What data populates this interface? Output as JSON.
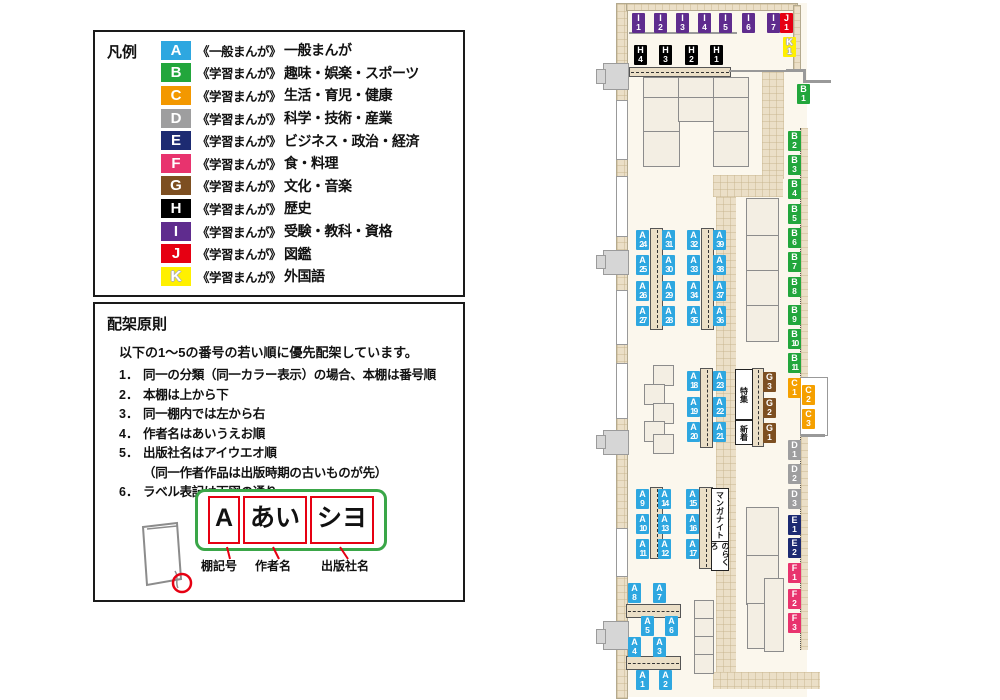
{
  "legend": {
    "title": "凡例",
    "items": [
      {
        "letter": "A",
        "color": "#2EA7E0",
        "series": "《一般まんが》",
        "category": "一般まんが"
      },
      {
        "letter": "B",
        "color": "#22A63C",
        "series": "《学習まんが》",
        "category": "趣味・娯楽・スポーツ"
      },
      {
        "letter": "C",
        "color": "#F39800",
        "series": "《学習まんが》",
        "category": "生活・育児・健康"
      },
      {
        "letter": "D",
        "color": "#9E9E9F",
        "series": "《学習まんが》",
        "category": "科学・技術・産業"
      },
      {
        "letter": "E",
        "color": "#1D2B72",
        "series": "《学習まんが》",
        "category": "ビジネス・政治・経済"
      },
      {
        "letter": "F",
        "color": "#E8336E",
        "series": "《学習まんが》",
        "category": "食・料理"
      },
      {
        "letter": "G",
        "color": "#7D4F21",
        "series": "《学習まんが》",
        "category": "文化・音楽"
      },
      {
        "letter": "H",
        "color": "#000000",
        "series": "《学習まんが》",
        "category": "歴史"
      },
      {
        "letter": "I",
        "color": "#5F2C8E",
        "series": "《学習まんが》",
        "category": "受験・教科・資格"
      },
      {
        "letter": "J",
        "color": "#E60012",
        "series": "《学習まんが》",
        "category": "図鑑"
      },
      {
        "letter": "K",
        "color": "#FFF000",
        "series": "《学習まんが》",
        "category": "外国語"
      }
    ]
  },
  "rules": {
    "title": "配架原則",
    "intro": "以下の1～5の番号の若い順に優先配架しています。",
    "items": [
      {
        "num": "1．",
        "text": "同一の分類（同一カラー表示）の場合、本棚は番号順"
      },
      {
        "num": "2．",
        "text": "本棚は上から下"
      },
      {
        "num": "3．",
        "text": "同一棚内では左から右"
      },
      {
        "num": "4．",
        "text": "作者名はあいうえお順"
      },
      {
        "num": "5．",
        "text": "出版社名はアイウエオ順"
      },
      {
        "num": "",
        "text": "（同一作者作品は出版時期の古いものが先）"
      },
      {
        "num": "6．",
        "text": "ラベル表記は下図の通り"
      }
    ],
    "label_diagram": {
      "cells": [
        "A",
        "あい",
        "シヨ"
      ],
      "captions": [
        "棚記号",
        "作者名",
        "出版社名"
      ]
    }
  },
  "map": {
    "colors": {
      "A": "#2EA7E0",
      "B": "#22A63C",
      "C": "#F5A000",
      "D": "#9E9E9F",
      "E": "#1D2B72",
      "F": "#E8336E",
      "G": "#7D4F21",
      "H": "#000000",
      "I": "#5F2C8E",
      "J": "#E60012",
      "K": "#FFF000"
    },
    "labels": [
      {
        "id": "A1",
        "x": 636,
        "y": 670
      },
      {
        "id": "A2",
        "x": 659,
        "y": 670
      },
      {
        "id": "A3",
        "x": 653,
        "y": 637
      },
      {
        "id": "A4",
        "x": 628,
        "y": 637
      },
      {
        "id": "A5",
        "x": 641,
        "y": 616
      },
      {
        "id": "A6",
        "x": 665,
        "y": 616
      },
      {
        "id": "A7",
        "x": 653,
        "y": 583
      },
      {
        "id": "A8",
        "x": 628,
        "y": 583
      },
      {
        "id": "A9",
        "x": 636,
        "y": 489
      },
      {
        "id": "A10",
        "x": 636,
        "y": 514
      },
      {
        "id": "A11",
        "x": 636,
        "y": 539
      },
      {
        "id": "A12",
        "x": 658,
        "y": 539
      },
      {
        "id": "A13",
        "x": 658,
        "y": 514
      },
      {
        "id": "A14",
        "x": 658,
        "y": 489
      },
      {
        "id": "A15",
        "x": 686,
        "y": 489
      },
      {
        "id": "A16",
        "x": 686,
        "y": 514
      },
      {
        "id": "A17",
        "x": 686,
        "y": 539
      },
      {
        "id": "A18",
        "x": 687,
        "y": 371
      },
      {
        "id": "A19",
        "x": 687,
        "y": 397
      },
      {
        "id": "A20",
        "x": 687,
        "y": 422
      },
      {
        "id": "A21",
        "x": 713,
        "y": 422
      },
      {
        "id": "A22",
        "x": 713,
        "y": 397
      },
      {
        "id": "A23",
        "x": 713,
        "y": 371
      },
      {
        "id": "A24",
        "x": 636,
        "y": 230
      },
      {
        "id": "A25",
        "x": 636,
        "y": 255
      },
      {
        "id": "A26",
        "x": 636,
        "y": 281
      },
      {
        "id": "A27",
        "x": 636,
        "y": 306
      },
      {
        "id": "A28",
        "x": 662,
        "y": 306
      },
      {
        "id": "A29",
        "x": 662,
        "y": 281
      },
      {
        "id": "A30",
        "x": 662,
        "y": 255
      },
      {
        "id": "A31",
        "x": 662,
        "y": 230
      },
      {
        "id": "A32",
        "x": 687,
        "y": 230
      },
      {
        "id": "A33",
        "x": 687,
        "y": 255
      },
      {
        "id": "A34",
        "x": 687,
        "y": 281
      },
      {
        "id": "A35",
        "x": 687,
        "y": 306
      },
      {
        "id": "A36",
        "x": 713,
        "y": 306
      },
      {
        "id": "A37",
        "x": 713,
        "y": 281
      },
      {
        "id": "A38",
        "x": 713,
        "y": 255
      },
      {
        "id": "A39",
        "x": 713,
        "y": 230
      },
      {
        "id": "B1",
        "x": 797,
        "y": 84
      },
      {
        "id": "B2",
        "x": 788,
        "y": 131
      },
      {
        "id": "B3",
        "x": 788,
        "y": 155
      },
      {
        "id": "B4",
        "x": 788,
        "y": 179
      },
      {
        "id": "B5",
        "x": 788,
        "y": 204
      },
      {
        "id": "B6",
        "x": 788,
        "y": 228
      },
      {
        "id": "B7",
        "x": 788,
        "y": 252
      },
      {
        "id": "B8",
        "x": 788,
        "y": 277
      },
      {
        "id": "B9",
        "x": 788,
        "y": 305
      },
      {
        "id": "B10",
        "x": 788,
        "y": 329
      },
      {
        "id": "B11",
        "x": 788,
        "y": 353
      },
      {
        "id": "C1",
        "x": 788,
        "y": 378
      },
      {
        "id": "C2",
        "x": 802,
        "y": 385
      },
      {
        "id": "C3",
        "x": 802,
        "y": 409
      },
      {
        "id": "D1",
        "x": 788,
        "y": 440
      },
      {
        "id": "D2",
        "x": 788,
        "y": 464
      },
      {
        "id": "D3",
        "x": 788,
        "y": 489
      },
      {
        "id": "E1",
        "x": 788,
        "y": 515
      },
      {
        "id": "E2",
        "x": 788,
        "y": 538
      },
      {
        "id": "F1",
        "x": 788,
        "y": 563
      },
      {
        "id": "F2",
        "x": 788,
        "y": 589
      },
      {
        "id": "F3",
        "x": 788,
        "y": 613
      },
      {
        "id": "G1",
        "x": 763,
        "y": 423
      },
      {
        "id": "G2",
        "x": 763,
        "y": 398
      },
      {
        "id": "G3",
        "x": 763,
        "y": 372
      },
      {
        "id": "H1",
        "x": 710,
        "y": 45
      },
      {
        "id": "H2",
        "x": 685,
        "y": 45
      },
      {
        "id": "H3",
        "x": 659,
        "y": 45
      },
      {
        "id": "H4",
        "x": 634,
        "y": 45
      },
      {
        "id": "I1",
        "x": 632,
        "y": 13
      },
      {
        "id": "I2",
        "x": 654,
        "y": 13
      },
      {
        "id": "I3",
        "x": 676,
        "y": 13
      },
      {
        "id": "I4",
        "x": 698,
        "y": 13
      },
      {
        "id": "I5",
        "x": 719,
        "y": 13
      },
      {
        "id": "I6",
        "x": 742,
        "y": 13
      },
      {
        "id": "I7",
        "x": 767,
        "y": 13
      },
      {
        "id": "J1",
        "x": 780,
        "y": 13
      },
      {
        "id": "K1",
        "x": 783,
        "y": 37
      }
    ],
    "signs": [
      {
        "text": "特集",
        "x": 735,
        "y": 369,
        "w": 16,
        "h": 49
      },
      {
        "text": "新着",
        "x": 735,
        "y": 420,
        "w": 16,
        "h": 23
      },
      {
        "text": "マンガナイト",
        "x": 711,
        "y": 488,
        "w": 16,
        "h": 52
      },
      {
        "text": "のらくろ",
        "x": 711,
        "y": 541,
        "w": 16,
        "h": 28
      }
    ]
  }
}
